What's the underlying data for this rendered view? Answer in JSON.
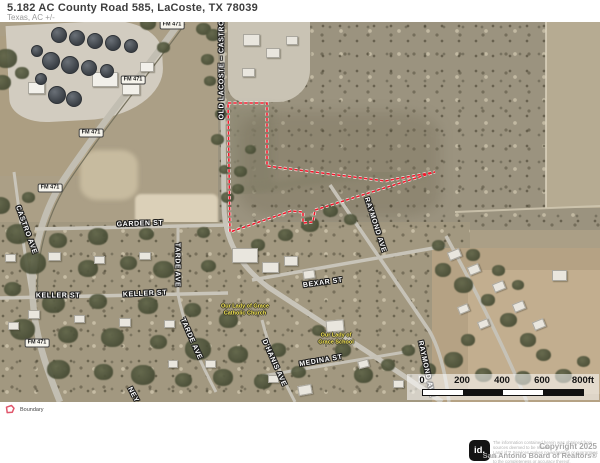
{
  "header": {
    "title": "5.182 AC County Road 585, LaCoste, TX 78039",
    "subtitle": "Texas,  AC +/-"
  },
  "map": {
    "street_labels": [
      {
        "text": "OLD LACOSTE – CASTROV",
        "x": 222,
        "y": 45,
        "r": -90
      },
      {
        "text": "CASTRO AVE",
        "x": 26,
        "y": 208,
        "r": 70
      },
      {
        "text": "GARDEN ST",
        "x": 140,
        "y": 202,
        "r": -2
      },
      {
        "text": "KELLER ST",
        "x": 58,
        "y": 274,
        "r": 0
      },
      {
        "text": "KELLER ST",
        "x": 145,
        "y": 272,
        "r": -3
      },
      {
        "text": "TARDE AVE",
        "x": 177,
        "y": 243,
        "r": 90
      },
      {
        "text": "TARDE AVE",
        "x": 191,
        "y": 317,
        "r": 66
      },
      {
        "text": "BEXAR ST",
        "x": 323,
        "y": 261,
        "r": -8
      },
      {
        "text": "MEDINA ST",
        "x": 321,
        "y": 339,
        "r": -10
      },
      {
        "text": "D'HANIS AVE",
        "x": 274,
        "y": 341,
        "r": 66
      },
      {
        "text": "RAYMOND AVE",
        "x": 375,
        "y": 203,
        "r": 72
      },
      {
        "text": "RAYMOND AVE",
        "x": 426,
        "y": 347,
        "r": 78
      },
      {
        "text": "NEY",
        "x": 133,
        "y": 373,
        "r": 62
      }
    ],
    "highway_labels": [
      {
        "text": "FM 471",
        "x": 172,
        "y": 3
      },
      {
        "text": "FM 471",
        "x": 133,
        "y": 58
      },
      {
        "text": "FM 471",
        "x": 91,
        "y": 111
      },
      {
        "text": "FM 471",
        "x": 50,
        "y": 166
      },
      {
        "text": "FM 471",
        "x": 37,
        "y": 321
      }
    ],
    "poi_labels": [
      {
        "line1": "Our Lady of Grace",
        "line2": "Catholic Church",
        "x": 245,
        "y": 288
      },
      {
        "line1": "Our Lady of",
        "line2": "Grace School",
        "x": 336,
        "y": 317
      }
    ],
    "scale_bar": {
      "ticks": [
        {
          "label": "0",
          "x": 15
        },
        {
          "label": "200",
          "x": 55
        },
        {
          "label": "400",
          "x": 95
        },
        {
          "label": "600",
          "x": 135
        },
        {
          "label": "800ft",
          "x": 176
        }
      ]
    },
    "boundary_color": "#f2182b"
  },
  "legend": {
    "boundary_label": "Boundary"
  },
  "footer": {
    "logo_text": "id.",
    "disclaimer_lines": [
      "The information contained herein was obtained from",
      "sources deemed to be reliable.",
      "Land id™ Services makes no warranties or guarantees as",
      "to the completeness or accuracy thereof."
    ],
    "copyright_line1": "Copyright 2025",
    "copyright_line2": "San Antonio Board of Realtors®"
  }
}
